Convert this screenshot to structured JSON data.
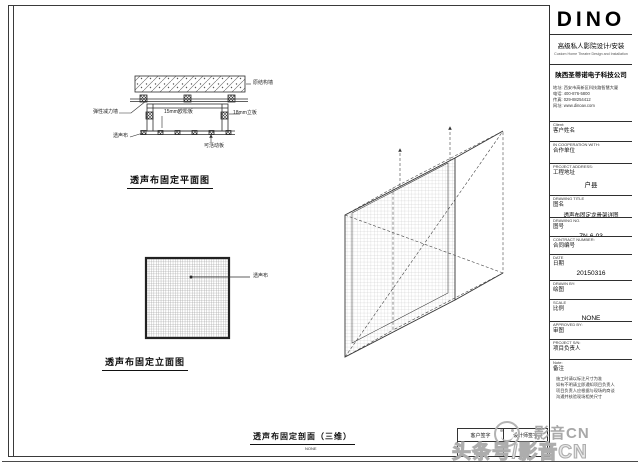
{
  "sheet": {
    "plan": {
      "title": "透声布固定平面图",
      "labels": {
        "slab": "原结构墙",
        "damper": "弹性减力墙",
        "osb": "15mm欧松板",
        "side": "18mm立板",
        "cloth": "透声布",
        "movable": "可活动板"
      }
    },
    "elevation": {
      "title": "透声布固定立面图",
      "label_cloth": "透声布"
    },
    "iso": {
      "title": "透声布固定剖面（三维）",
      "scale": "NONE"
    },
    "signature": {
      "cells": [
        "客户签字",
        "设计师签字"
      ]
    }
  },
  "title_block": {
    "logo": "DINO",
    "tagline_cn": "高级私人影院设计/安装",
    "tagline_en": "Custom Home Theatre Design and Installation",
    "company": "陕西圣蒂诺电子科技公司",
    "address": [
      "地址: 西安市高新区科技路智慧大厦",
      "电话: 400-876-5800",
      "传真: 029-88254412",
      "网址: www.dinoav.com"
    ],
    "client": {
      "en": "Client:",
      "cn": "客户姓名"
    },
    "coop": {
      "en": "IN COOPERATION WITH:",
      "cn": "合作单位"
    },
    "project_address": {
      "en": "PROJECT ADDRESS:",
      "cn": "工程地址",
      "value": "户县"
    },
    "drawing_title": {
      "en": "DRAWING TITLE",
      "cn": "图名",
      "value": "透声布固定龙骨架详图"
    },
    "drawing_no": {
      "en": "DRAWING NO.",
      "cn": "图号",
      "value": "ZN-6-03"
    },
    "contract": {
      "en": "CONTRACT NUMBER:",
      "cn": "合同编号"
    },
    "date": {
      "en": "DATE",
      "cn": "日期",
      "value": "20150316"
    },
    "drawn": {
      "en": "DRAWN BY:",
      "cn": "绘图"
    },
    "scale": {
      "en": "SCALE",
      "cn": "比例",
      "value": "NONE"
    },
    "approved": {
      "en": "APPROVED BY:",
      "cn": "审图"
    },
    "project_sn": {
      "en": "PROJECT S/N:",
      "cn": "项目负责人"
    },
    "note": {
      "en": "Note:",
      "cn": "备注",
      "lines": [
        "施工时请以标注尺寸为准",
        "如有不明请立即通知项目负责人",
        "项目负责人应根据与现场的商谈",
        "沟通并核验现场相关尺寸"
      ]
    }
  },
  "watermark": {
    "small": "影音CN",
    "large": "头条号/影音CN"
  }
}
